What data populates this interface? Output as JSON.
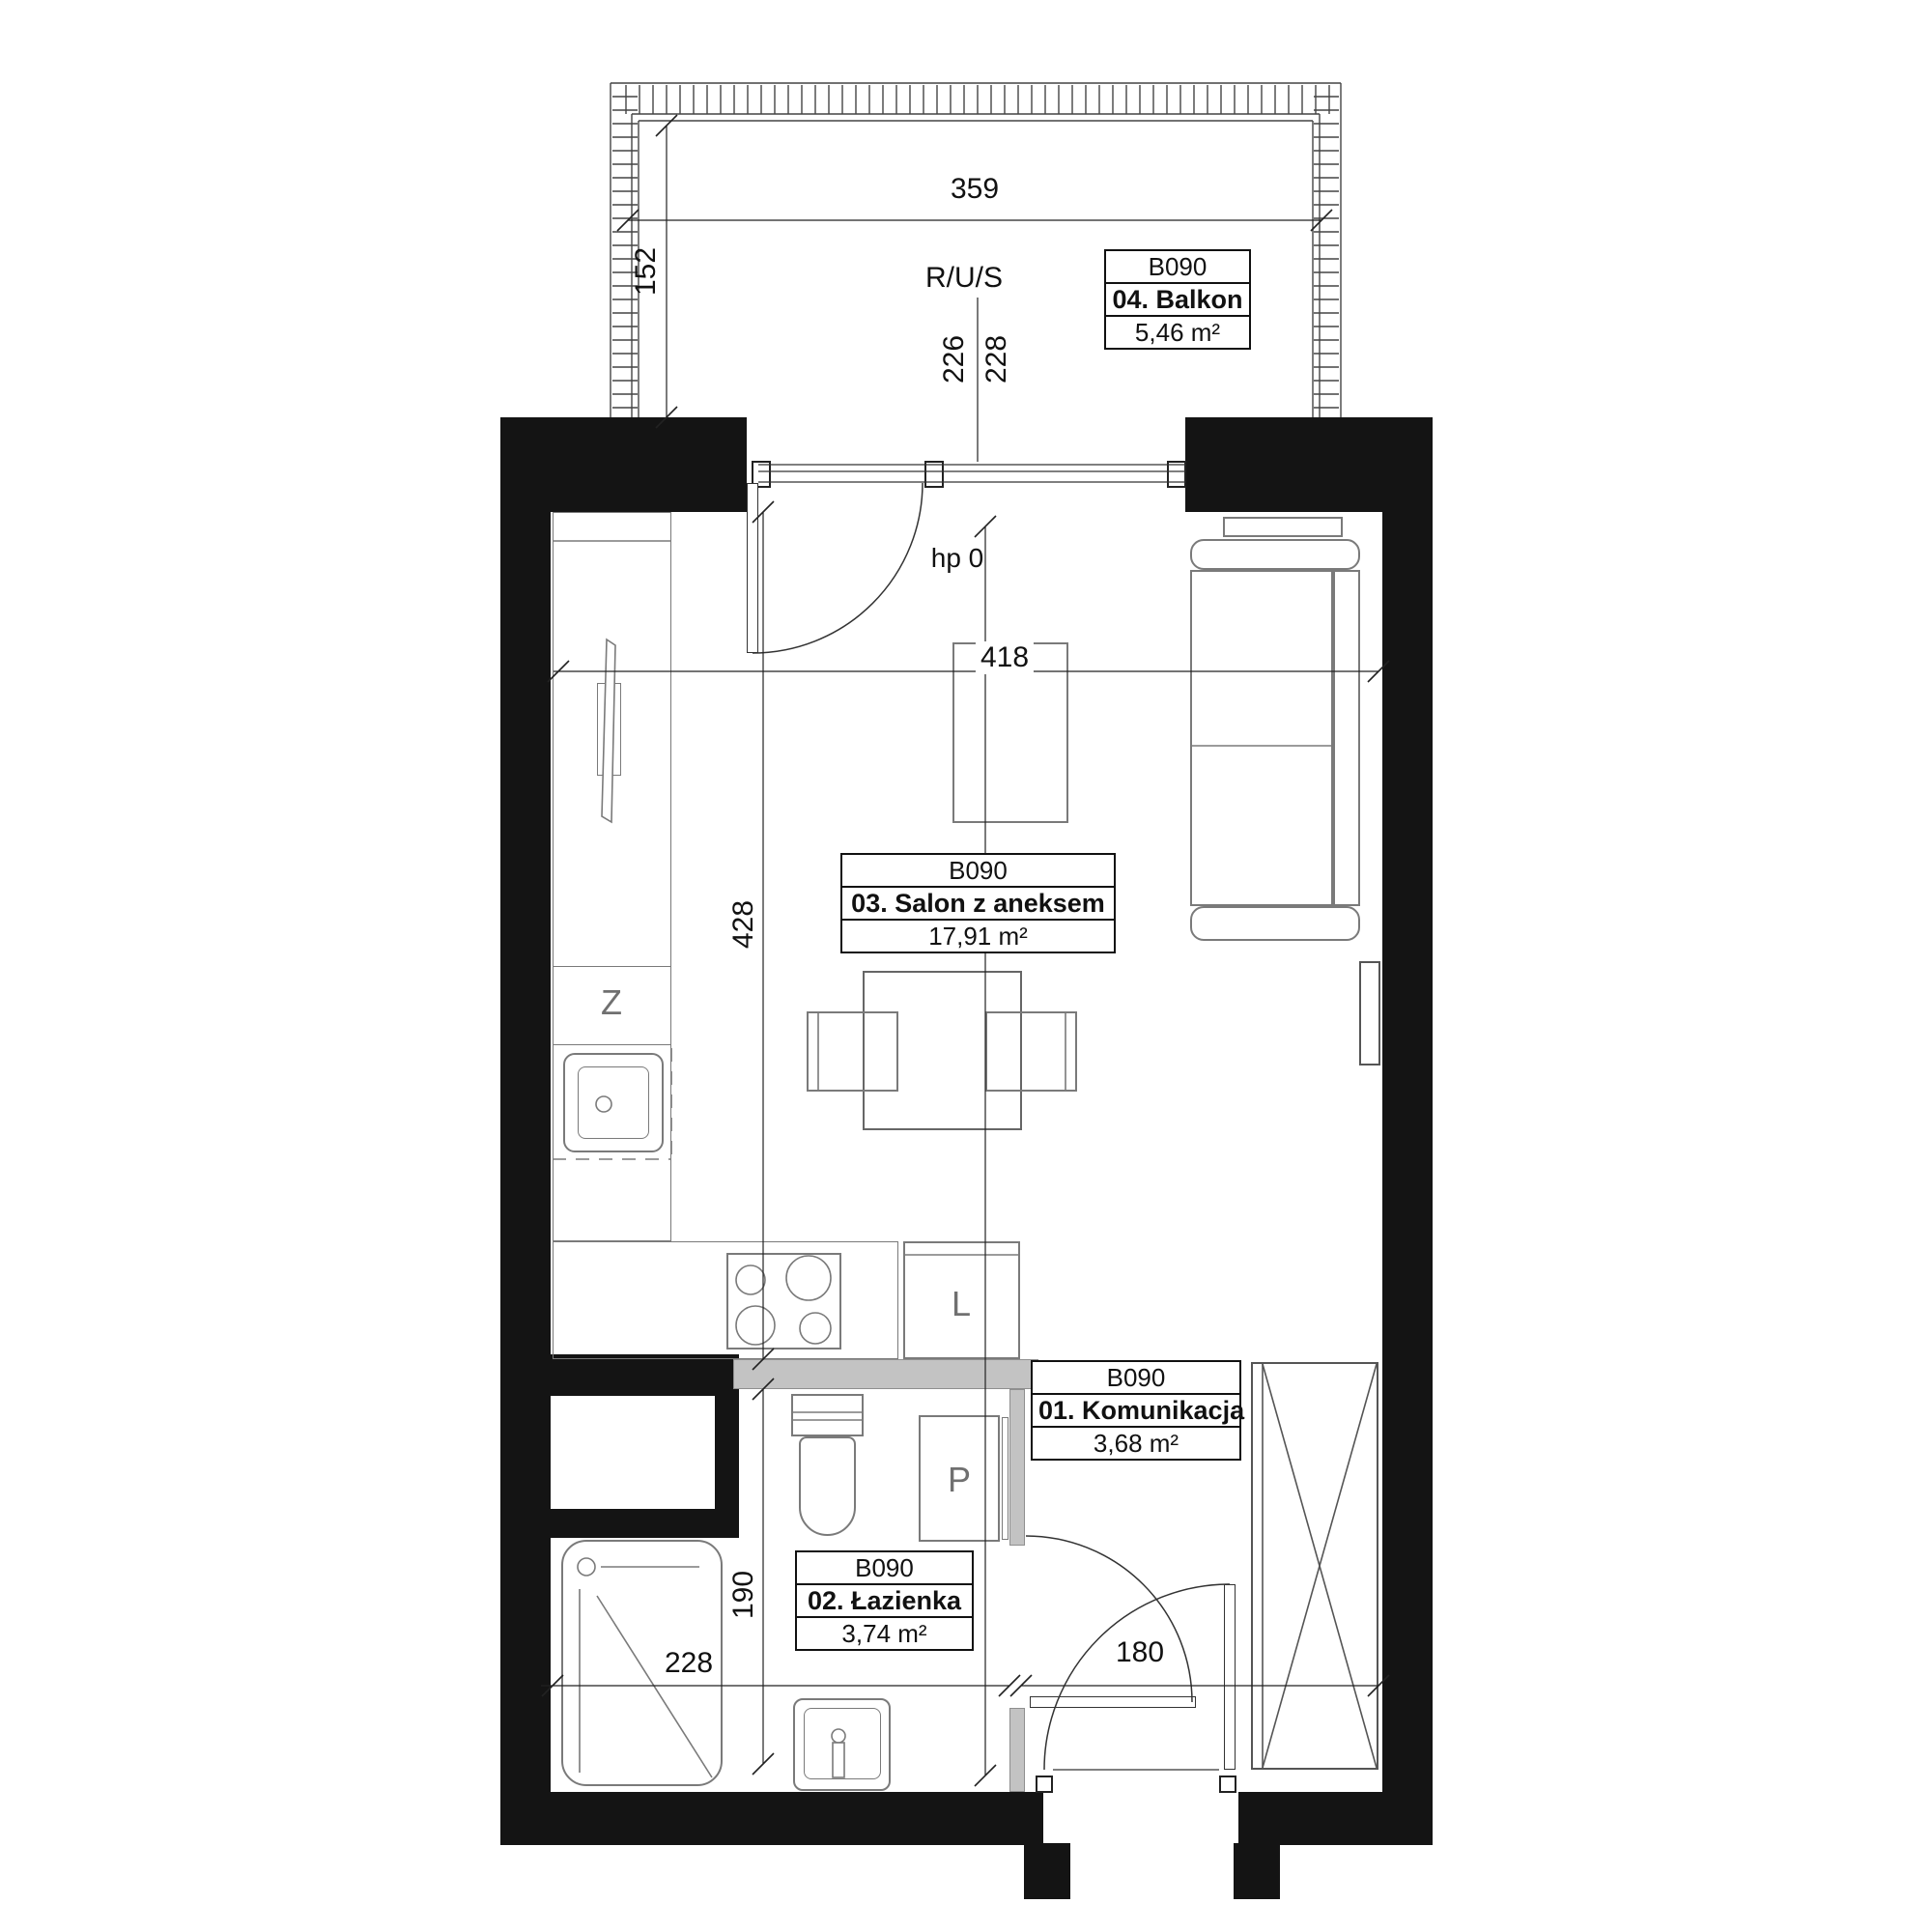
{
  "unit_code": "B090",
  "rooms": {
    "komunikacja": {
      "code": "B090",
      "name": "01. Komunikacja",
      "area": "3,68 m²"
    },
    "lazienka": {
      "code": "B090",
      "name": "02. Łazienka",
      "area": "3,74 m²"
    },
    "salon": {
      "code": "B090",
      "name": "03. Salon z aneksem",
      "area": "17,91 m²"
    },
    "balkon": {
      "code": "B090",
      "name": "04. Balkon",
      "area": "5,46 m²"
    }
  },
  "dimensions": {
    "balcony_width": "359",
    "balcony_depth": "152",
    "balcony_door_left": "226",
    "balcony_door_right": "228",
    "salon_width": "418",
    "kitchen_zone_depth": "428",
    "salon_depth": "633",
    "bathroom_depth": "190",
    "bathroom_width": "228",
    "hall_width": "180"
  },
  "annotations": {
    "riser": "R/U/S",
    "door_sill_height": "hp 0",
    "kitchen_sink_cabinet": "Z",
    "fridge_cabinet": "L",
    "washing_machine": "P"
  }
}
